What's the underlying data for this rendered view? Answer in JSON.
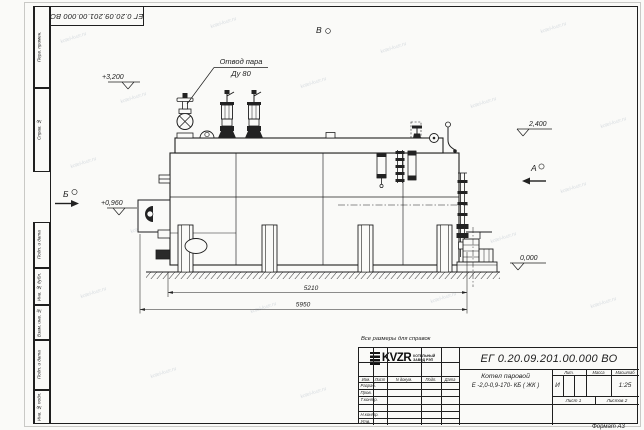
{
  "watermark": "kotel-kvzr.ru",
  "frame_stamps": {
    "top_number": "ЕГ 0.20.09.201.00.000  ВО",
    "left_top": [
      "Перв. примен.",
      "Справ. №"
    ],
    "left_bottom": [
      "Подп. и дата",
      "Инв. № дубл.",
      "Взам. инв. №",
      "Подп. и дата",
      "Инв. № подл."
    ],
    "format_note": "Формат А3"
  },
  "drawing": {
    "steam_outlet_label": {
      "line1": "Отвод пара",
      "line2": "Ду 80"
    },
    "views": {
      "a": "А",
      "b": "Б",
      "v": "В"
    },
    "elevations": {
      "top": "+3,200",
      "drum": "2,400",
      "burner": "+0,960",
      "ground": "0,000"
    },
    "dimensions": {
      "boiler_length": "5210",
      "overall_length": "5950"
    },
    "reference_note": "Все размеры для справок"
  },
  "title_block": {
    "doc_number": "ЕГ 0.20.09.201.00.000  ВО",
    "product_name_line1": "Котел паровой",
    "product_name_line2": "Е -2,0-0,9-170- КБ ( ЖК )",
    "table_headers": [
      "Изм.",
      "Лист",
      "N докум.",
      "Подп.",
      "Дата"
    ],
    "signature_rows": [
      "Разраб.",
      "Пров.",
      "Т.контр.",
      "Н.контр.",
      "Утв."
    ],
    "lit_header": "Лит.",
    "lit_value": "И",
    "mass_header": "Масса",
    "scale_header": "Масштаб",
    "scale_value": "1:25",
    "sheet_info": "Лист 1",
    "sheets_info": "Листов 2",
    "logo_text": "KVZR",
    "company_line1": "КОТЕЛЬНЫЙ",
    "company_line2": "ЗАВОД РЭП"
  }
}
